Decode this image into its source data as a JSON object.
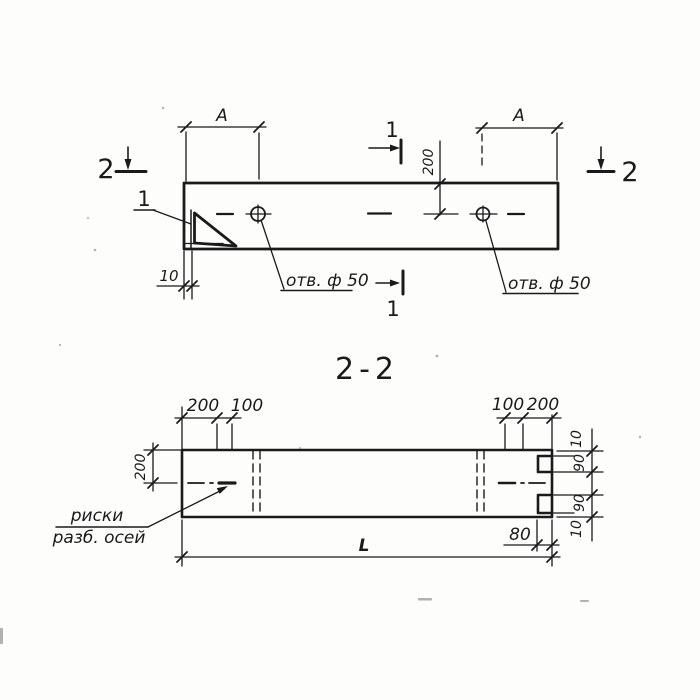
{
  "title": "2-2",
  "colors": {
    "ink": "#1a1a1a",
    "paper": "#fdfdfb"
  },
  "plan_view": {
    "dim_a_left": "A",
    "dim_a_right": "A",
    "dim_top_to_hole": "200",
    "dim_edge_strip": "10",
    "section1_label": "1",
    "section2_label": "2",
    "corner_detail_label": "1",
    "hole_label_left": "отв. ф 50",
    "hole_label_right": "отв. ф 50"
  },
  "section_view": {
    "dims_top_left": [
      "200",
      "100"
    ],
    "dims_top_right": [
      "100",
      "200"
    ],
    "dim_height": "200",
    "dims_right_edge": [
      "10",
      "90",
      "90",
      "10"
    ],
    "dim_notch_depth": "80",
    "dim_length": "L",
    "axis_marks_label": [
      "риски",
      "разб. осей"
    ]
  }
}
